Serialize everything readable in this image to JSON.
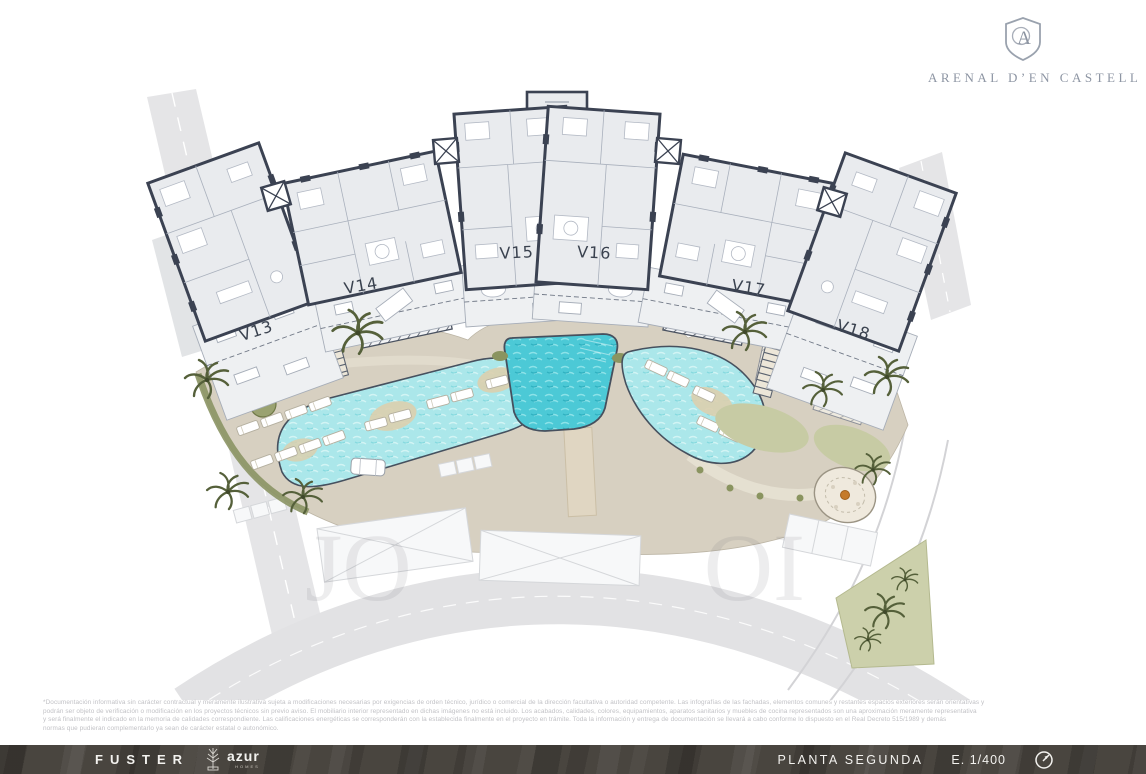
{
  "brand": {
    "name": "ARENAL D’EN CASTELL",
    "emblem_letter": "A"
  },
  "plan": {
    "floor_label": "PLANTA SEGUNDA",
    "units": [
      {
        "label": "V13"
      },
      {
        "label": "V14"
      },
      {
        "label": "V15"
      },
      {
        "label": "V16"
      },
      {
        "label": "V17"
      },
      {
        "label": "V18"
      }
    ],
    "watermark": {
      "left": "JO",
      "right": "OI"
    }
  },
  "disclaimer": {
    "lines": [
      "*Documentación informativa sin carácter contractual y meramente ilustrativa sujeta a modificaciones necesarias por exigencias de orden técnico, jurídico o comercial de la dirección facultativa o autoridad competente. Las infografías de las fachadas, elementos comunes y restantes espacios exteriores serán orientativas y",
      "podrán ser objeto de verificación o modificación en los proyectos técnicos sin previo aviso. El mobiliario interior representado en dichas imágenes no está incluido. Los acabados, calidades, colores, equipamientos, aparatos sanitarios y muebles de cocina representados son una aproximación meramente representativa",
      "y será finalmente el indicado en la memoria de calidades correspondiente. Las calificaciones energéticas se corresponderán con la establecida finalmente en el proyecto en trámite. Toda la información y entrega de documentación se llevará a cabo conforme lo dispuesto en el Real Decreto 515/1989 y demás",
      "normas que pudieran complementarlo ya sean de carácter estatal o autonómico."
    ]
  },
  "footer": {
    "developer": "FUSTER",
    "builder": "azur",
    "builder_sub": "HOMES",
    "floor": "PLANTA SEGUNDA",
    "scale": "E. 1/400"
  },
  "colors": {
    "wall": "#3b4252",
    "floor": "#e9ebee",
    "balcony": "#eef0f2",
    "deck": "#d7d0c1",
    "pool_light": "#abe7ea",
    "pool_deep": "#4cc9d6",
    "green": "#8a9460",
    "road": "#e5e5e7",
    "brand_gray": "#8d95a3",
    "footer_bg": "#49453f",
    "fire_pit_accent": "#c57a2a"
  }
}
